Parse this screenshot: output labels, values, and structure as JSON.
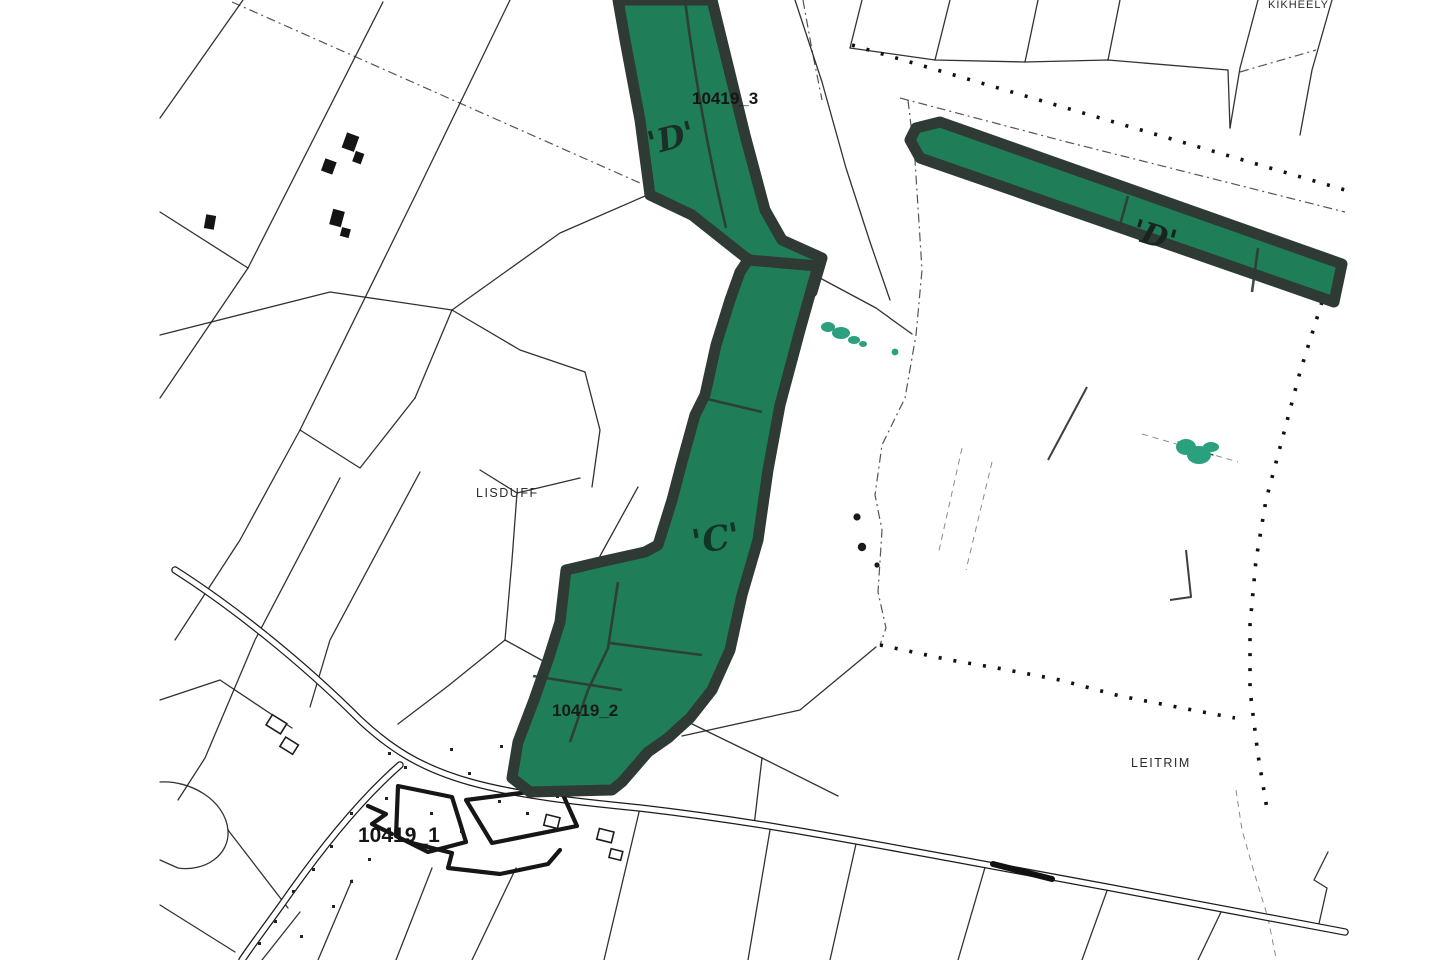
{
  "map": {
    "type": "scanned cadastral land-registry map",
    "labels": {
      "parcel3_id": "10419_3",
      "parcel2_id": "10419_2",
      "parcel1_id": "10419_1",
      "letter_d_north": "'D'",
      "letter_d_east": "'D'",
      "letter_c": "'C'",
      "townland_lisduff": "LISDUFF",
      "townland_leitrim": "LEITRIM",
      "townland_kiheely": "KIKHEELY"
    },
    "colors": {
      "parcel_fill": "#1f7d58",
      "parcel_border": "#2e3a33",
      "highlight_teal": "#2aa07f",
      "line": "#1c1c1c",
      "paper": "#ffffff"
    }
  }
}
